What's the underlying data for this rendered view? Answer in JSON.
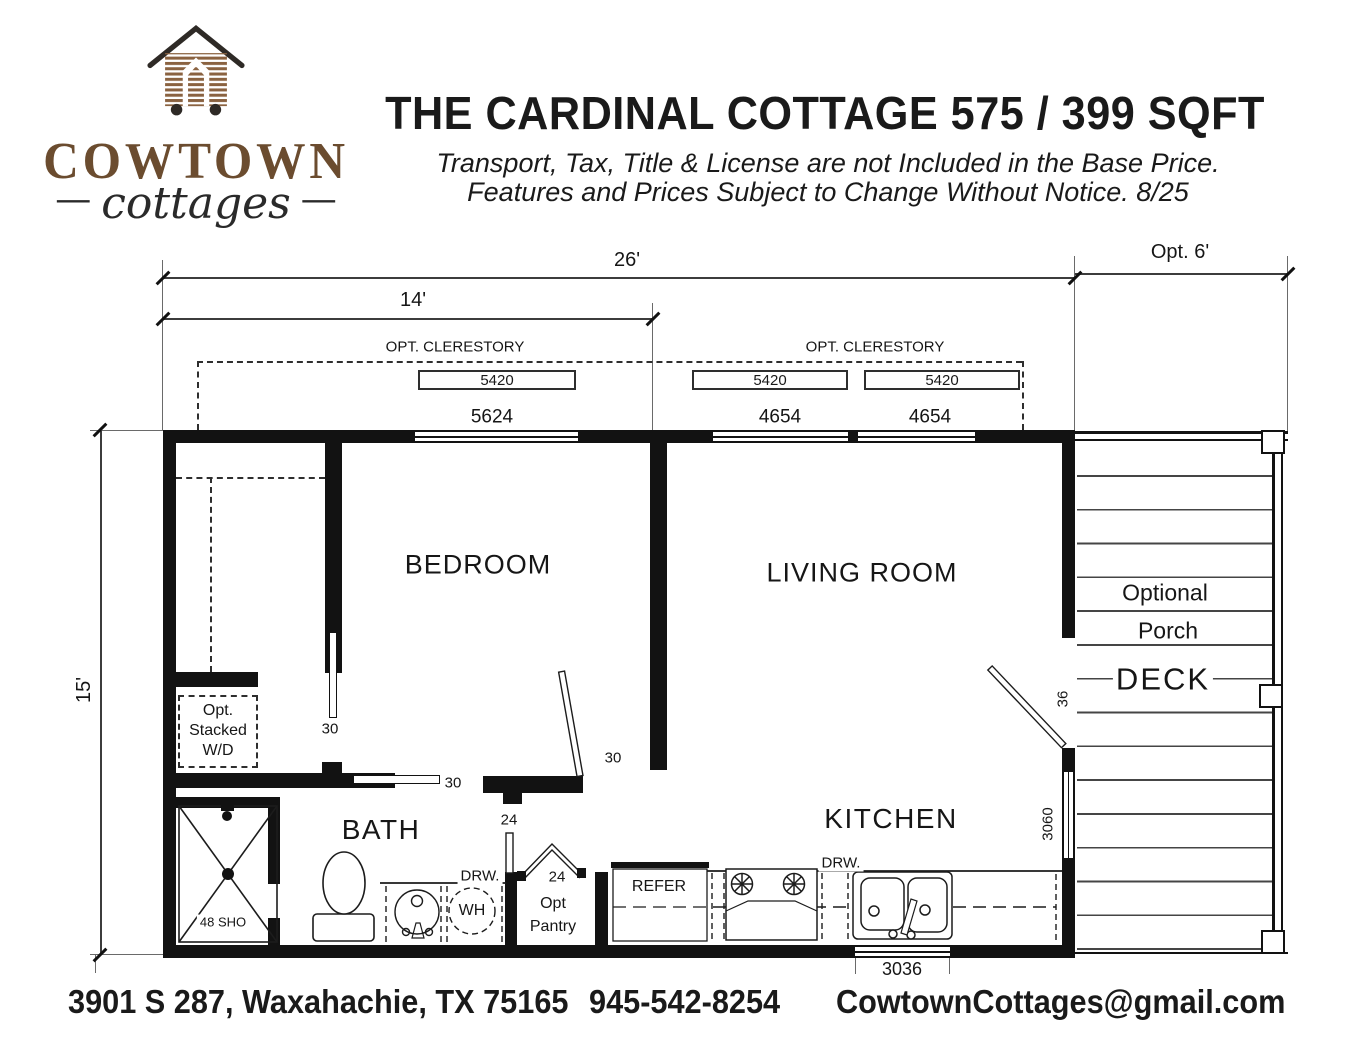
{
  "header": {
    "logo": {
      "wordmark": "COWTOWN",
      "script": "cottages",
      "dash_left": "—",
      "dash_right": "—"
    },
    "title": "THE CARDINAL COTTAGE 575 / 399 SQFT",
    "disclaimer_line1": "Transport, Tax, Title & License are not Included in the Base Price.",
    "disclaimer_line2": "Features and Prices Subject to Change Without Notice. 8/25"
  },
  "dimensions": {
    "overall_width": "26'",
    "left_section_width": "14'",
    "porch_width": "Opt. 6'",
    "depth": "15'"
  },
  "clerestory": {
    "left_label": "OPT. CLERESTORY",
    "right_label": "OPT. CLERESTORY",
    "size_1": "5420",
    "size_2": "5420",
    "size_3": "5420"
  },
  "windows": {
    "top_left": "5624",
    "top_mid": "4654",
    "top_right": "4654",
    "kitchen": "3036",
    "living_side": "3060"
  },
  "rooms": {
    "bedroom": "BEDROOM",
    "living_room": "LIVING ROOM",
    "bath": "BATH",
    "kitchen": "KITCHEN",
    "deck": "DECK",
    "porch_line1": "Optional",
    "porch_line2": "Porch"
  },
  "doors": {
    "closet": "30",
    "bath": "30",
    "bedroom": "30",
    "bath_entry": "24",
    "pantry": "24",
    "deck": "36"
  },
  "fixtures": {
    "washer_dryer_line1": "Opt.",
    "washer_dryer_line2": "Stacked",
    "washer_dryer_line3": "W/D",
    "shower": "48 SHO",
    "water_heater": "WH",
    "bath_drawer": "DRW.",
    "kitchen_drawer": "DRW.",
    "refrigerator": "REFER",
    "pantry_line1": "Opt",
    "pantry_line2": "Pantry"
  },
  "footer": {
    "address": "3901 S 287, Waxahachie, TX 75165",
    "phone": "945-542-8254",
    "email": "CowtownCottages@gmail.com"
  }
}
